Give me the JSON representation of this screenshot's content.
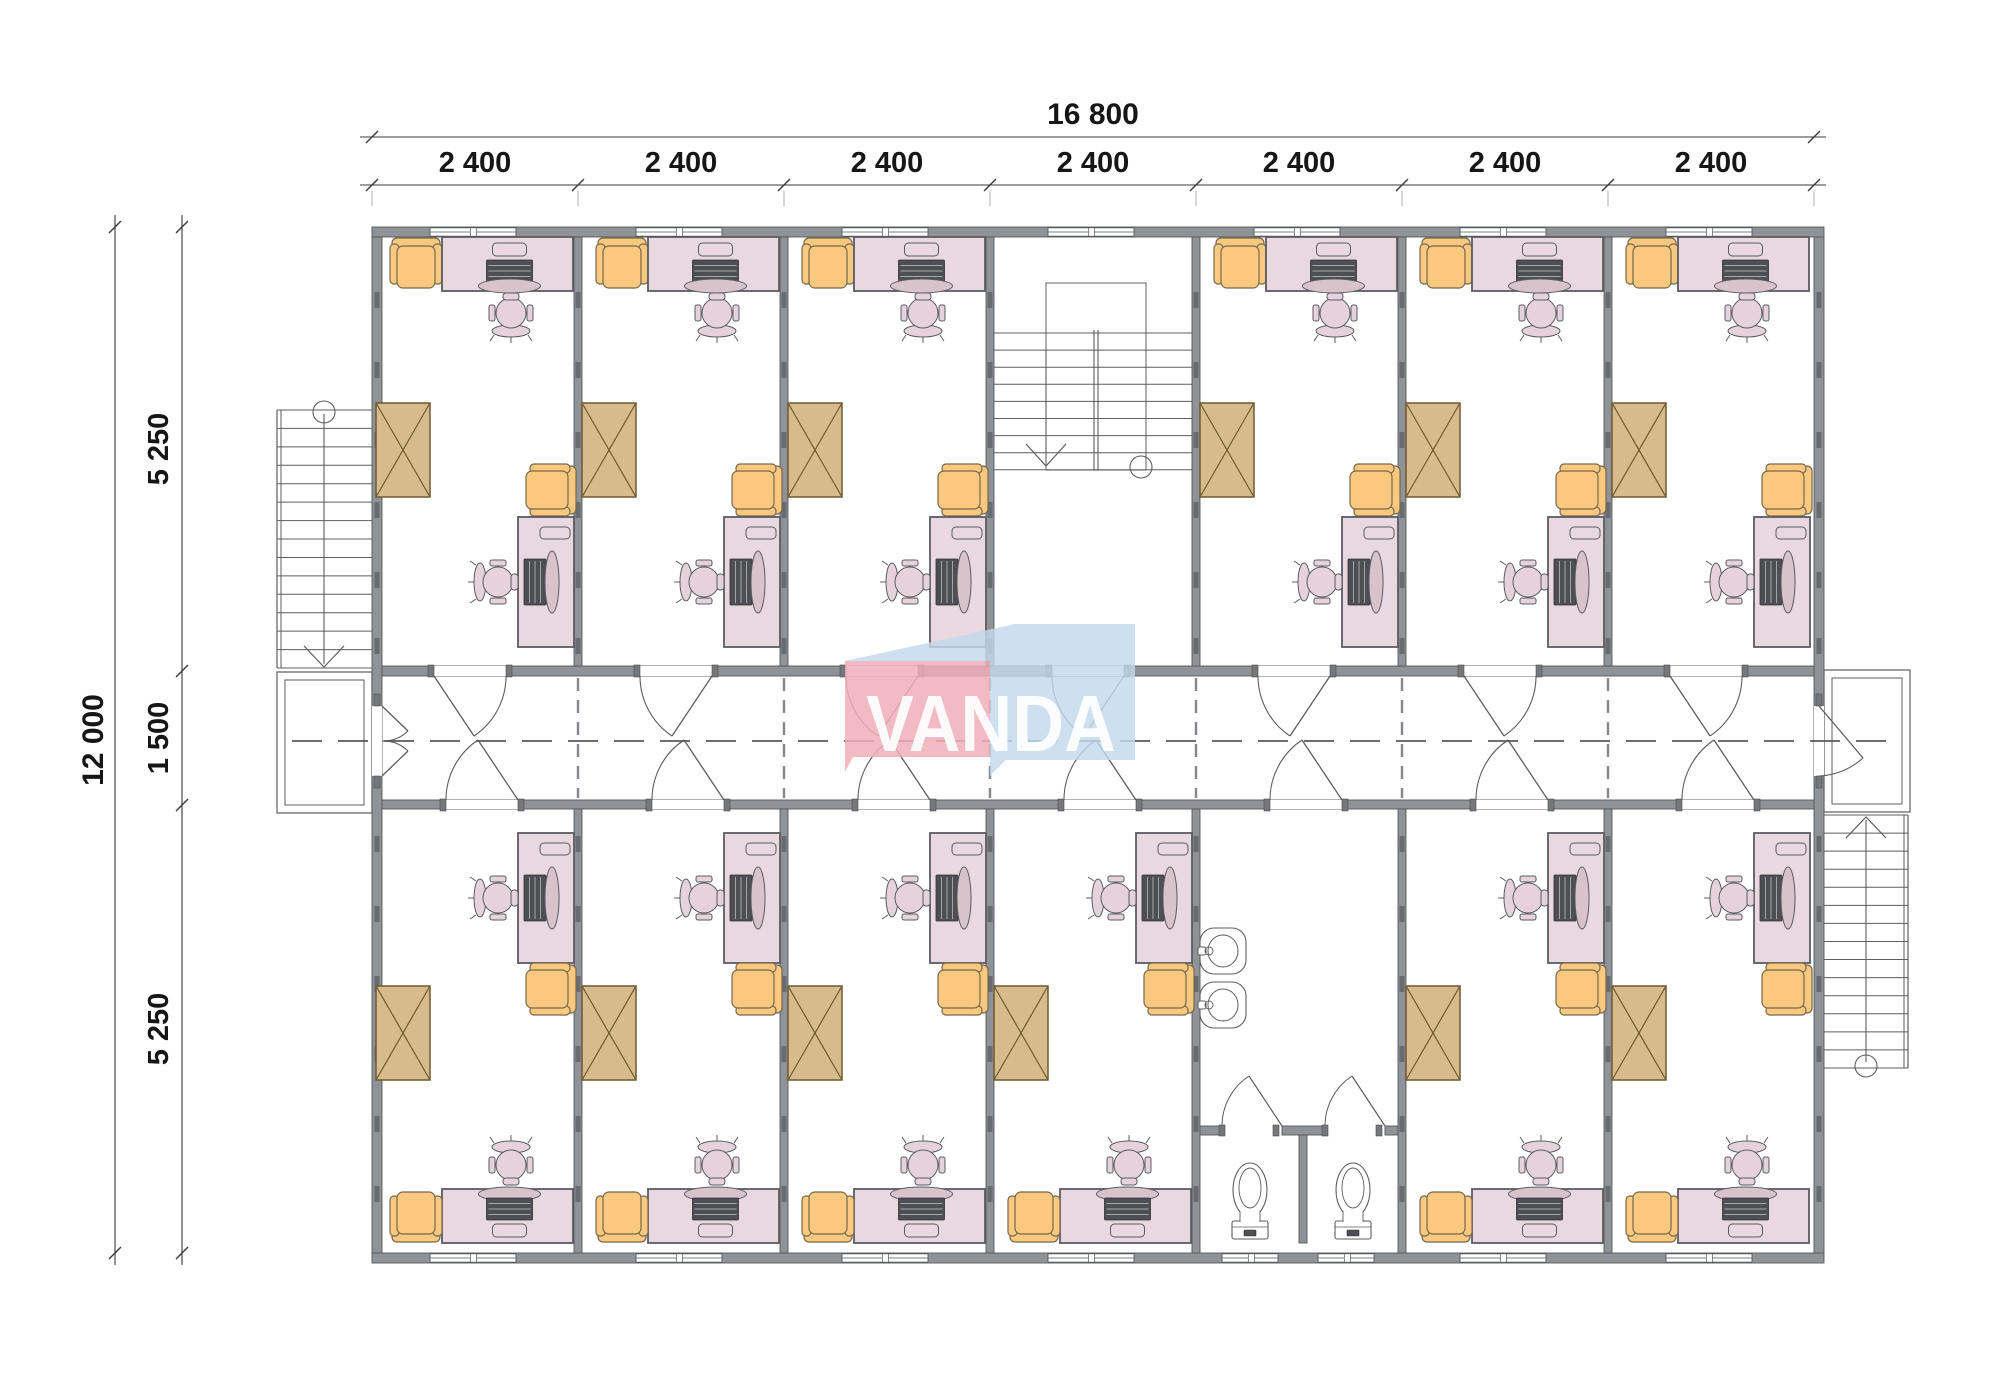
{
  "document": {
    "kind": "architectural floor plan",
    "building": "modular office block, 7 bays, central corridor"
  },
  "logo": {
    "text": "VANDA",
    "pink": "#f0aeb9",
    "blue": "#c3d9ed",
    "text_color": "#ffffff"
  },
  "dimensions": {
    "top_total": "16 800",
    "top_bays": [
      "2 400",
      "2 400",
      "2 400",
      "2 400",
      "2 400",
      "2 400",
      "2 400"
    ],
    "left_total": "12 000",
    "left_segments": [
      "5 250",
      "1 500",
      "5 250"
    ]
  },
  "colors": {
    "wall_fill": "#8f9296",
    "wall_stroke": "#55585c",
    "joint_mark": "#686b70",
    "line": "#5d5d5d",
    "dim_line": "#3a3a3a",
    "dim_text": "#161616",
    "desk_fill": "#e9d8df",
    "desk_stroke": "#5a5c62",
    "monitor_fill": "#d8c3cb",
    "keyboard_fill": "#4e4e55",
    "chair_fill": "#e6d2da",
    "armchair_fill": "#fac87e",
    "armchair_stroke": "#77674a",
    "cabinet_fill": "#d8bb8c",
    "cabinet_stroke": "#6f5930",
    "centerline": "#595959"
  },
  "rooms": [
    {
      "label": "office",
      "row": "top",
      "bay": 1
    },
    {
      "label": "office",
      "row": "top",
      "bay": 2
    },
    {
      "label": "office",
      "row": "top",
      "bay": 3
    },
    {
      "label": "stairwell",
      "row": "top",
      "bay": 4
    },
    {
      "label": "office",
      "row": "top",
      "bay": 5
    },
    {
      "label": "office",
      "row": "top",
      "bay": 6
    },
    {
      "label": "office",
      "row": "top",
      "bay": 7
    },
    {
      "label": "office",
      "row": "bottom",
      "bay": 1
    },
    {
      "label": "office",
      "row": "bottom",
      "bay": 2
    },
    {
      "label": "office",
      "row": "bottom",
      "bay": 3
    },
    {
      "label": "office",
      "row": "bottom",
      "bay": 4
    },
    {
      "label": "washroom",
      "row": "bottom",
      "bay": 5
    },
    {
      "label": "office",
      "row": "bottom",
      "bay": 6
    },
    {
      "label": "office",
      "row": "bottom",
      "bay": 7
    }
  ],
  "office_inventory": [
    "desk with computer x2",
    "task chair x2",
    "armchair",
    "side chair",
    "cabinet"
  ],
  "washroom_inventory": [
    "sink x2",
    "toilet stall x2"
  ],
  "exterior": [
    "stairs with landing left",
    "stairs with landing right"
  ]
}
